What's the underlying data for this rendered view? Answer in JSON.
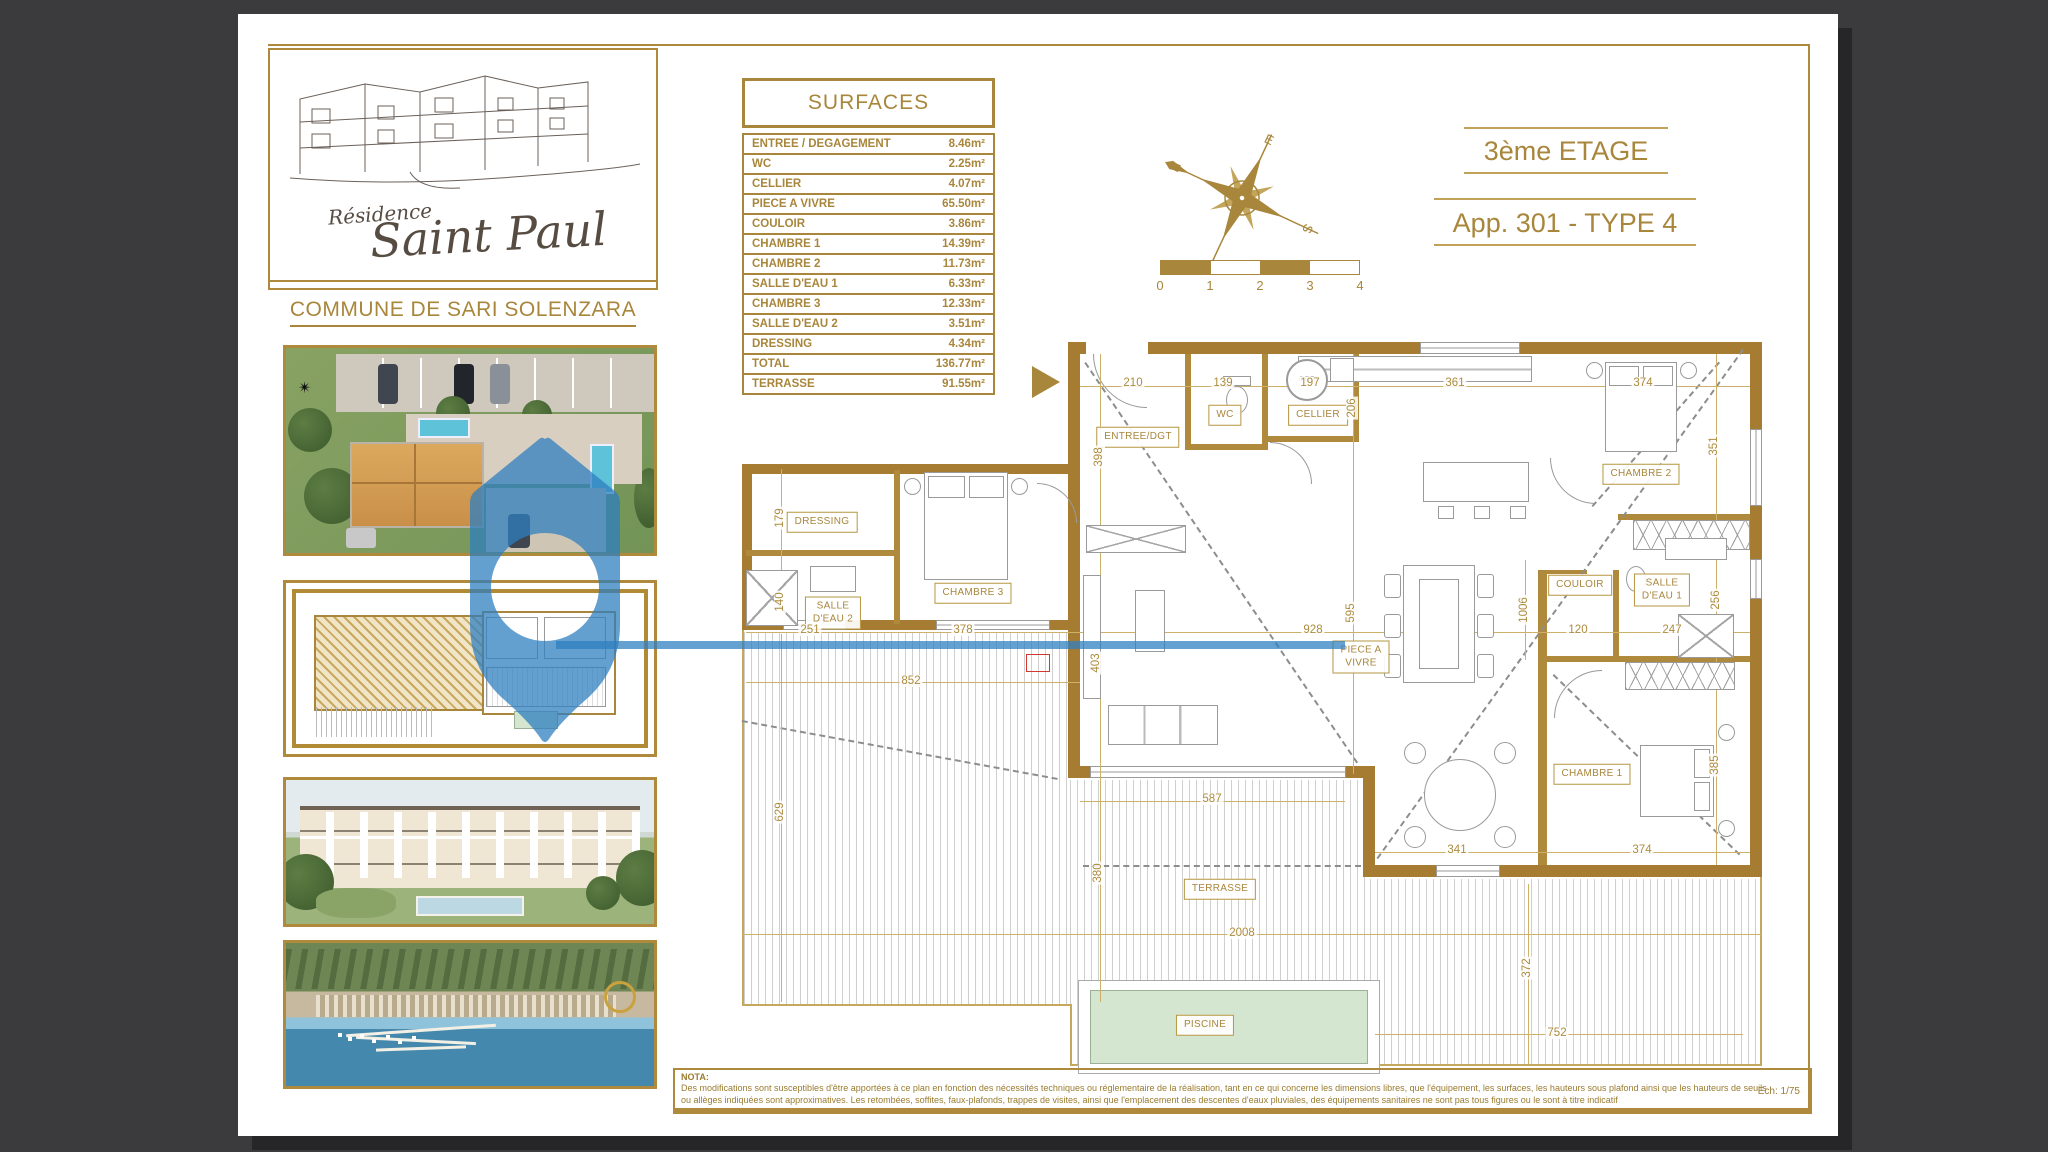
{
  "branding": {
    "residence_small": "Résidence",
    "residence_large": "Saint Paul",
    "commune": "COMMUNE DE SARI SOLENZARA"
  },
  "titles": {
    "floor": "3ème ETAGE",
    "apartment": "App. 301 - TYPE 4"
  },
  "surfaces_table": {
    "header": "SURFACES",
    "rows": [
      {
        "label": "ENTREE / DEGAGEMENT",
        "value": "8.46m²"
      },
      {
        "label": "WC",
        "value": "2.25m²"
      },
      {
        "label": "CELLIER",
        "value": "4.07m²"
      },
      {
        "label": "PIECE A VIVRE",
        "value": "65.50m²"
      },
      {
        "label": "COULOIR",
        "value": "3.86m²"
      },
      {
        "label": "CHAMBRE 1",
        "value": "14.39m²"
      },
      {
        "label": "CHAMBRE 2",
        "value": "11.73m²"
      },
      {
        "label": "SALLE D'EAU 1",
        "value": "6.33m²"
      },
      {
        "label": "CHAMBRE 3",
        "value": "12.33m²"
      },
      {
        "label": "SALLE D'EAU 2",
        "value": "3.51m²"
      },
      {
        "label": "DRESSING",
        "value": "4.34m²"
      },
      {
        "label": "TOTAL",
        "value": "136.77m²"
      },
      {
        "label": "TERRASSE",
        "value": "91.55m²"
      }
    ]
  },
  "scale_bar": {
    "labels": [
      "0",
      "1",
      "2",
      "3",
      "4"
    ]
  },
  "compass": {
    "north": "N",
    "south": "S",
    "east": "E",
    "west": "O"
  },
  "plan": {
    "cet_label": "C.E.T.",
    "rooms": [
      {
        "label": "ENTREE/DGT",
        "x": 900,
        "y": 423
      },
      {
        "label": "WC",
        "x": 987,
        "y": 401
      },
      {
        "label": "CELLIER",
        "x": 1080,
        "y": 401
      },
      {
        "label": "DRESSING",
        "x": 584,
        "y": 508
      },
      {
        "label": "SALLE\nD'EAU 2",
        "x": 595,
        "y": 599
      },
      {
        "label": "CHAMBRE 3",
        "x": 735,
        "y": 579
      },
      {
        "label": "CHAMBRE 2",
        "x": 1403,
        "y": 460
      },
      {
        "label": "COULOIR",
        "x": 1342,
        "y": 571
      },
      {
        "label": "SALLE\nD'EAU 1",
        "x": 1424,
        "y": 576
      },
      {
        "label": "CHAMBRE 1",
        "x": 1354,
        "y": 760
      },
      {
        "label": "PIECE A\nVIVRE",
        "x": 1123,
        "y": 643
      },
      {
        "label": "TERRASSE",
        "x": 982,
        "y": 875
      },
      {
        "label": "PISCINE",
        "x": 967,
        "y": 1011
      }
    ],
    "dimensions": [
      {
        "t": "210",
        "x": 895,
        "y": 369,
        "r": 0
      },
      {
        "t": "139",
        "x": 985,
        "y": 369,
        "r": 0
      },
      {
        "t": "197",
        "x": 1072,
        "y": 369,
        "r": 0
      },
      {
        "t": "361",
        "x": 1217,
        "y": 369,
        "r": 0
      },
      {
        "t": "374",
        "x": 1405,
        "y": 369,
        "r": 0
      },
      {
        "t": "398",
        "x": 861,
        "y": 443,
        "r": -90
      },
      {
        "t": "206",
        "x": 1114,
        "y": 394,
        "r": -90
      },
      {
        "t": "351",
        "x": 1476,
        "y": 432,
        "r": -90
      },
      {
        "t": "179",
        "x": 542,
        "y": 504,
        "r": -90
      },
      {
        "t": "140",
        "x": 542,
        "y": 588,
        "r": -90
      },
      {
        "t": "251",
        "x": 572,
        "y": 616,
        "r": 0
      },
      {
        "t": "378",
        "x": 725,
        "y": 616,
        "r": 0
      },
      {
        "t": "852",
        "x": 673,
        "y": 667,
        "r": 0
      },
      {
        "t": "928",
        "x": 1075,
        "y": 616,
        "r": 0
      },
      {
        "t": "595",
        "x": 1113,
        "y": 599,
        "r": -90
      },
      {
        "t": "1006",
        "x": 1286,
        "y": 596,
        "r": -90
      },
      {
        "t": "120",
        "x": 1340,
        "y": 616,
        "r": 0
      },
      {
        "t": "247",
        "x": 1434,
        "y": 616,
        "r": 0
      },
      {
        "t": "256",
        "x": 1478,
        "y": 586,
        "r": -90
      },
      {
        "t": "403",
        "x": 858,
        "y": 649,
        "r": -90
      },
      {
        "t": "629",
        "x": 542,
        "y": 798,
        "r": -90
      },
      {
        "t": "380",
        "x": 860,
        "y": 859,
        "r": -90
      },
      {
        "t": "587",
        "x": 974,
        "y": 785,
        "r": 0
      },
      {
        "t": "341",
        "x": 1219,
        "y": 836,
        "r": 0
      },
      {
        "t": "374",
        "x": 1404,
        "y": 836,
        "r": 0
      },
      {
        "t": "385",
        "x": 1477,
        "y": 751,
        "r": -90
      },
      {
        "t": "2008",
        "x": 1004,
        "y": 919,
        "r": 0
      },
      {
        "t": "372",
        "x": 1289,
        "y": 954,
        "r": -90
      },
      {
        "t": "752",
        "x": 1319,
        "y": 1019,
        "r": 0
      }
    ]
  },
  "nota": {
    "title": "NOTA:",
    "line1": "Des modifications sont susceptibles d'être apportées à ce plan en fonction des nécessités techniques ou réglementaire de la réalisation, tant en ce qui concerne les dimensions libres, que l'équipement, les surfaces, les hauteurs sous plafond ainsi que les hauteurs de seuils",
    "line2": "ou allèges indiquées sont approximatives. Les retombées, soffites, faux-plafonds, trappes de visites, ainsi que l'emplacement des descentes d'eaux pluviales, des équipements sanitaires ne sont pas tous figures ou le sont à titre indicatif",
    "scale": "Ech: 1/75"
  },
  "colors": {
    "gold": "#a8863b",
    "wall": "#a67c32",
    "watermark_blue": "#2e7fc0",
    "pool": "#d4e6cf"
  }
}
